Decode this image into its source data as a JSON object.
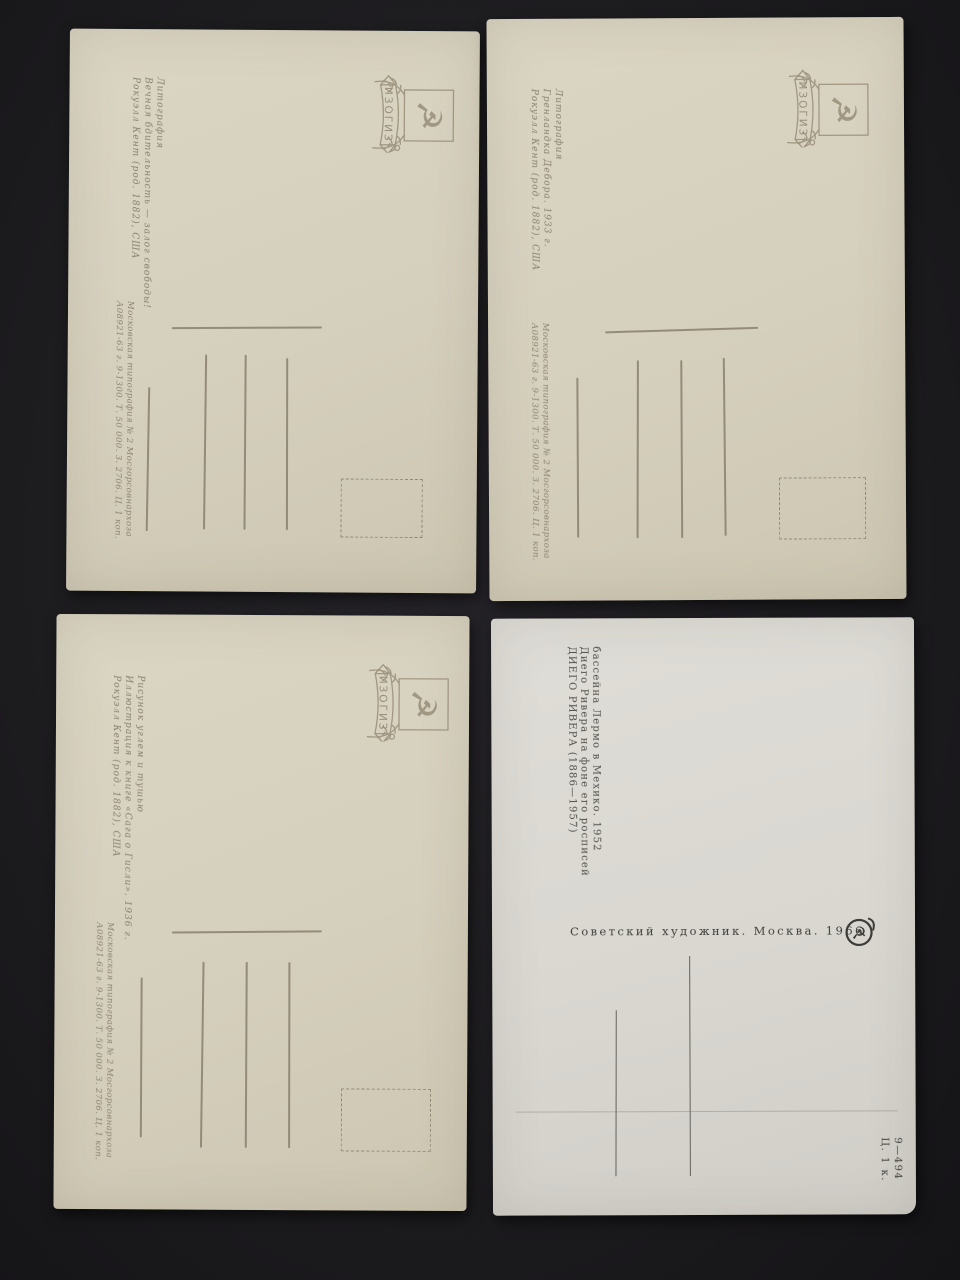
{
  "scene": "four postcard backs photographed on a dark surface",
  "emblem": {
    "label": "ИЗОГИЗ"
  },
  "colors": {
    "background": "#1d1c1f",
    "card_cream": "#d5cfbd",
    "card_white": "#d9d7d0",
    "print_gray": "#867f6c",
    "ink_dark": "#4e4e49"
  },
  "cards": [
    {
      "position": "top-left",
      "caption_lines": [
        "Рокуэлл Кент (род. 1882), США",
        "Вечная бдительность — залог свободы!",
        "Литография"
      ],
      "imprint_lines": [
        "А08921-63 г. 9-1300. Т. 50 000. З. 2706. Ц. 1 коп.",
        "Московская типография № 2 Мосгорсовнархоза"
      ]
    },
    {
      "position": "top-right",
      "caption_lines": [
        "Рокуэлл Кент (род. 1882), США",
        "Гренландка Дебора. 1933 г.",
        "Литография"
      ],
      "imprint_lines": [
        "А08921-63 г. 9-1300. Т. 50 000. З. 2706. Ц. 1 коп.",
        "Московская типография № 2 Мосгорсовнархоза"
      ]
    },
    {
      "position": "bottom-left",
      "caption_lines": [
        "Рокуэлл Кент (род. 1882), США",
        "Иллюстрация к книге «Сага о Гисли». 1936 г.",
        "Рисунок углем и тушью"
      ],
      "imprint_lines": [
        "А08921-63 г. 9-1300. Т. 50 000. З. 2706. Ц. 1 коп.",
        "Московская типография № 2 Мосгорсовнархоза"
      ]
    },
    {
      "position": "bottom-right",
      "caption_lines": [
        "ДИЕГО РИВЕРА (1886—1957)",
        "Диего Ривера на фоне его росписей",
        "бассейна Лермо в Мехико. 1952"
      ],
      "publisher_line": "Советский художник. Москва. 1966",
      "corner_lines": [
        "9—494",
        "Ц. 1 к."
      ]
    }
  ]
}
